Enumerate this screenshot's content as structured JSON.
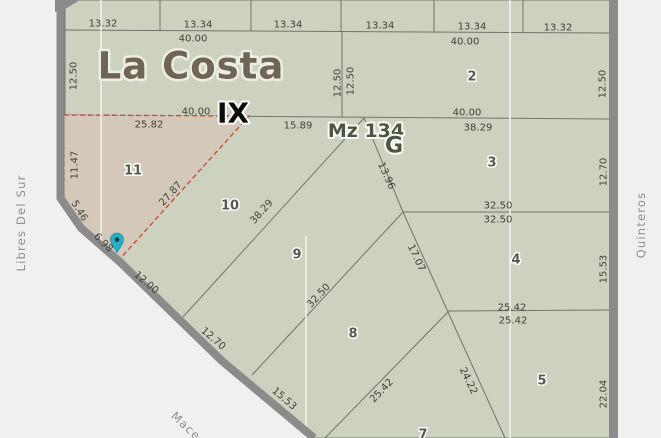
{
  "map": {
    "locality": "La Costa",
    "section": "IX",
    "block": "Mz 134",
    "block_letter": "G",
    "highlighted_parcel": "11",
    "parcel_numbers": [
      "2",
      "3",
      "4",
      "5",
      "7",
      "8",
      "9",
      "10",
      "11"
    ],
    "streets": [
      "Libres Del Sur",
      "Quinteros",
      "Mace"
    ],
    "marker": {
      "x": 117,
      "y": 240,
      "color": "#27afc1",
      "dot_color": "#123f47"
    },
    "colors": {
      "background": "#f0f0ee",
      "parcel_fill": "#ccd1c0",
      "highlight_fill": "#d4c8ba",
      "highlight_stroke": "#c8503c",
      "boundary_line": "#70756a",
      "section_line": "#f7f7f2",
      "road": "#8b8b8b",
      "dimension_text": "#3e433a",
      "street_text": "#8e8e8e",
      "locality_text": "#6f6556",
      "block_text": "#4c5640"
    },
    "labels": [
      {
        "kind": "dim",
        "text": "13.32",
        "x": 103,
        "y": 24,
        "rot": 0
      },
      {
        "kind": "dim",
        "text": "13.34",
        "x": 198,
        "y": 25,
        "rot": 0
      },
      {
        "kind": "dim",
        "text": "13.34",
        "x": 288,
        "y": 25,
        "rot": 0
      },
      {
        "kind": "dim",
        "text": "13.34",
        "x": 380,
        "y": 26,
        "rot": 0
      },
      {
        "kind": "dim",
        "text": "13.34",
        "x": 472,
        "y": 27,
        "rot": 0
      },
      {
        "kind": "dim",
        "text": "13.32",
        "x": 558,
        "y": 28,
        "rot": 0
      },
      {
        "kind": "dim",
        "text": "40.00",
        "x": 193,
        "y": 39,
        "rot": 0
      },
      {
        "kind": "dim",
        "text": "40.00",
        "x": 465,
        "y": 42,
        "rot": 0
      },
      {
        "kind": "dim",
        "text": "12.50",
        "x": 74,
        "y": 76,
        "rot": -90
      },
      {
        "kind": "dim",
        "text": "12.50",
        "x": 338,
        "y": 83,
        "rot": -90
      },
      {
        "kind": "dim",
        "text": "12.50",
        "x": 351,
        "y": 81,
        "rot": -90
      },
      {
        "kind": "dim",
        "text": "12.50",
        "x": 603,
        "y": 84,
        "rot": -90
      },
      {
        "kind": "dim",
        "text": "40.00",
        "x": 196,
        "y": 112,
        "rot": 0
      },
      {
        "kind": "dim",
        "text": "40.00",
        "x": 467,
        "y": 113,
        "rot": 0
      },
      {
        "kind": "dim",
        "text": "25.82",
        "x": 149,
        "y": 125,
        "rot": 0
      },
      {
        "kind": "dim",
        "text": "15.89",
        "x": 298,
        "y": 126,
        "rot": 0
      },
      {
        "kind": "dim",
        "text": "38.29",
        "x": 478,
        "y": 128,
        "rot": 0
      },
      {
        "kind": "dim",
        "text": "11.47",
        "x": 75,
        "y": 165,
        "rot": -90
      },
      {
        "kind": "dim",
        "text": "27.87",
        "x": 171,
        "y": 194,
        "rot": -48
      },
      {
        "kind": "dim",
        "text": "5.46",
        "x": 79,
        "y": 211,
        "rot": 58
      },
      {
        "kind": "dim",
        "text": "6.98",
        "x": 103,
        "y": 243,
        "rot": 45
      },
      {
        "kind": "dim",
        "text": "12.00",
        "x": 146,
        "y": 283,
        "rot": 41
      },
      {
        "kind": "dim",
        "text": "12.70",
        "x": 213,
        "y": 339,
        "rot": 41
      },
      {
        "kind": "dim",
        "text": "15.53",
        "x": 284,
        "y": 399,
        "rot": 41
      },
      {
        "kind": "dim",
        "text": "38.29",
        "x": 262,
        "y": 212,
        "rot": -48
      },
      {
        "kind": "dim",
        "text": "13.96",
        "x": 386,
        "y": 176,
        "rot": 66
      },
      {
        "kind": "dim",
        "text": "32.50",
        "x": 498,
        "y": 206,
        "rot": 0
      },
      {
        "kind": "dim",
        "text": "32.50",
        "x": 498,
        "y": 220,
        "rot": 0
      },
      {
        "kind": "dim",
        "text": "12.70",
        "x": 604,
        "y": 172,
        "rot": -90
      },
      {
        "kind": "dim",
        "text": "17.07",
        "x": 416,
        "y": 258,
        "rot": 65
      },
      {
        "kind": "dim",
        "text": "32.50",
        "x": 319,
        "y": 296,
        "rot": -47
      },
      {
        "kind": "dim",
        "text": "15.53",
        "x": 604,
        "y": 269,
        "rot": -90
      },
      {
        "kind": "dim",
        "text": "25.42",
        "x": 512,
        "y": 308,
        "rot": 0
      },
      {
        "kind": "dim",
        "text": "25.42",
        "x": 513,
        "y": 321,
        "rot": 0
      },
      {
        "kind": "dim",
        "text": "25.42",
        "x": 382,
        "y": 391,
        "rot": -46
      },
      {
        "kind": "dim",
        "text": "24.22",
        "x": 468,
        "y": 381,
        "rot": 64
      },
      {
        "kind": "dim",
        "text": "22.04",
        "x": 604,
        "y": 394,
        "rot": -90
      },
      {
        "kind": "parcel",
        "text": "2",
        "x": 472,
        "y": 77,
        "rot": 0
      },
      {
        "kind": "parcel",
        "text": "3",
        "x": 492,
        "y": 163,
        "rot": 0
      },
      {
        "kind": "parcel",
        "text": "4",
        "x": 516,
        "y": 260,
        "rot": 0
      },
      {
        "kind": "parcel",
        "text": "5",
        "x": 542,
        "y": 381,
        "rot": 0
      },
      {
        "kind": "parcel",
        "text": "7",
        "x": 423,
        "y": 435,
        "rot": 0
      },
      {
        "kind": "parcel",
        "text": "8",
        "x": 353,
        "y": 334,
        "rot": 0
      },
      {
        "kind": "parcel",
        "text": "9",
        "x": 297,
        "y": 255,
        "rot": 0
      },
      {
        "kind": "parcel",
        "text": "10",
        "x": 230,
        "y": 206,
        "rot": 0
      },
      {
        "kind": "parcel",
        "text": "11",
        "x": 133,
        "y": 171,
        "rot": 0
      },
      {
        "kind": "street",
        "text": "Libres Del Sur",
        "x": 21,
        "y": 223,
        "rot": -90
      },
      {
        "kind": "street",
        "text": "Quinteros",
        "x": 641,
        "y": 225,
        "rot": -90
      },
      {
        "kind": "street",
        "text": "Mace",
        "x": 186,
        "y": 426,
        "rot": 43
      },
      {
        "kind": "locality",
        "text": "La Costa",
        "x": 191,
        "y": 66,
        "rot": 0
      },
      {
        "kind": "section",
        "text": "IX",
        "x": 233,
        "y": 113,
        "rot": 0
      },
      {
        "kind": "mz",
        "text": "Mz 134",
        "x": 366,
        "y": 131,
        "rot": 0
      },
      {
        "kind": "mzg",
        "text": "G",
        "x": 394,
        "y": 146,
        "rot": 0
      }
    ]
  }
}
